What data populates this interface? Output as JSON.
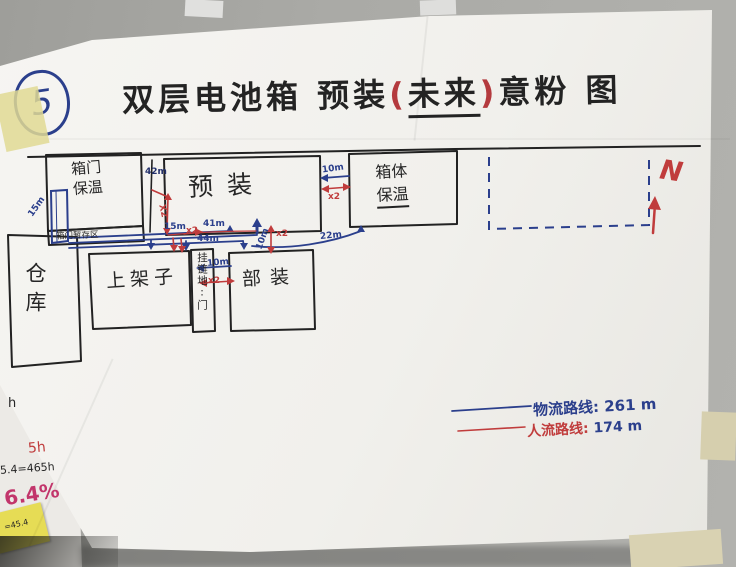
{
  "page_label": "5",
  "title": {
    "part1": "双层电池箱 预装",
    "paren_open": "(",
    "highlight": "未来",
    "paren_close": ")",
    "part2": "意粉 图"
  },
  "north": {
    "label": "N"
  },
  "rooms": {
    "warehouse": "仓库",
    "door_insulation_line1": "箱门",
    "door_insulation_line2": "保温",
    "door_storage": "箱门暂存区",
    "preassembly": "预装",
    "body_insulation_line1": "箱体",
    "body_insulation_line2": "保温",
    "shelf": "上架子",
    "hang_strip": "挂链地:门",
    "part_assembly": "部装"
  },
  "measurements": {
    "top_gap": "42m",
    "left_door": "15m",
    "x2_vertical": "X2",
    "mid_15": "15m",
    "x2_mid": "x2",
    "line_41": "41m",
    "line_44": "44m",
    "gap_10": "10m",
    "x2_gap": "x2",
    "line_22": "22m",
    "vert_10": "10m",
    "x2_vert10": "x2",
    "strip_10": "10m",
    "x2_strip": "x2"
  },
  "legend": {
    "material_label": "物流路线:",
    "material_value": "261 m",
    "people_label": "人流路线:",
    "people_value": "174 m"
  },
  "side_notes": {
    "note1": "h",
    "note2": "5h",
    "note3": "5.4=465h",
    "note4": "6.4%",
    "note5": "=45.4"
  },
  "colors": {
    "logistics_blue": "#2b3f8c",
    "people_red": "#c03c3c"
  }
}
